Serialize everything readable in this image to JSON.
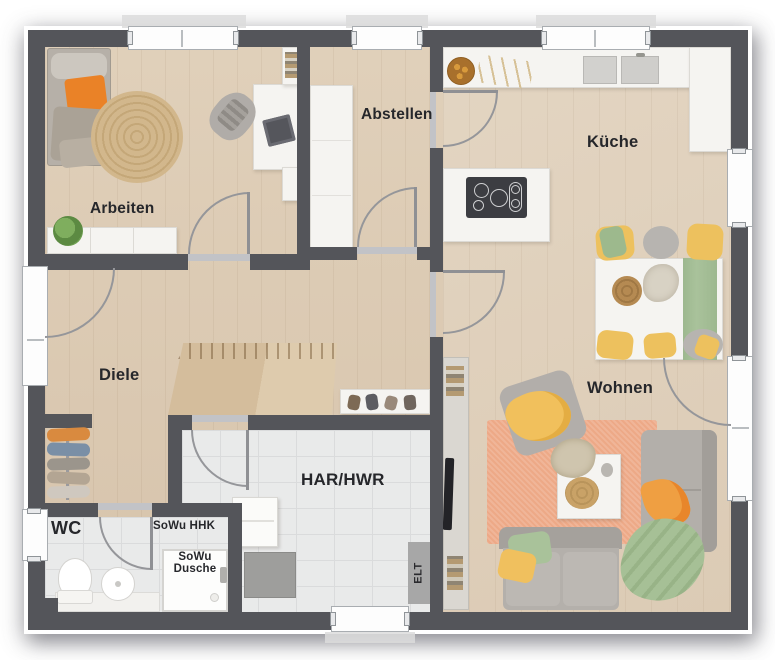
{
  "plan": {
    "type": "floor-plan",
    "floor_label_style": "German residential ground floor"
  },
  "rooms": {
    "arbeiten": "Arbeiten",
    "abstellen": "Abstellen",
    "kueche": "Küche",
    "diele": "Diele",
    "wohnen": "Wohnen",
    "har_hwr": "HAR/HWR",
    "wc": "WC"
  },
  "annotations": {
    "sowu_hhk": "SoWu HHK",
    "sowu_dusche_line1": "SoWu",
    "sowu_dusche_line2": "Dusche",
    "elt": "ELT"
  },
  "colors": {
    "wall": "#54555a",
    "wood_floor": "#dbc9b3",
    "tile_floor": "#e9eaea",
    "accent_orange": "#ee8324",
    "accent_yellow": "#f0c05e",
    "accent_green": "#a6c096",
    "rug_salmon": "#eda987",
    "rug_jute": "#d2b78c"
  }
}
